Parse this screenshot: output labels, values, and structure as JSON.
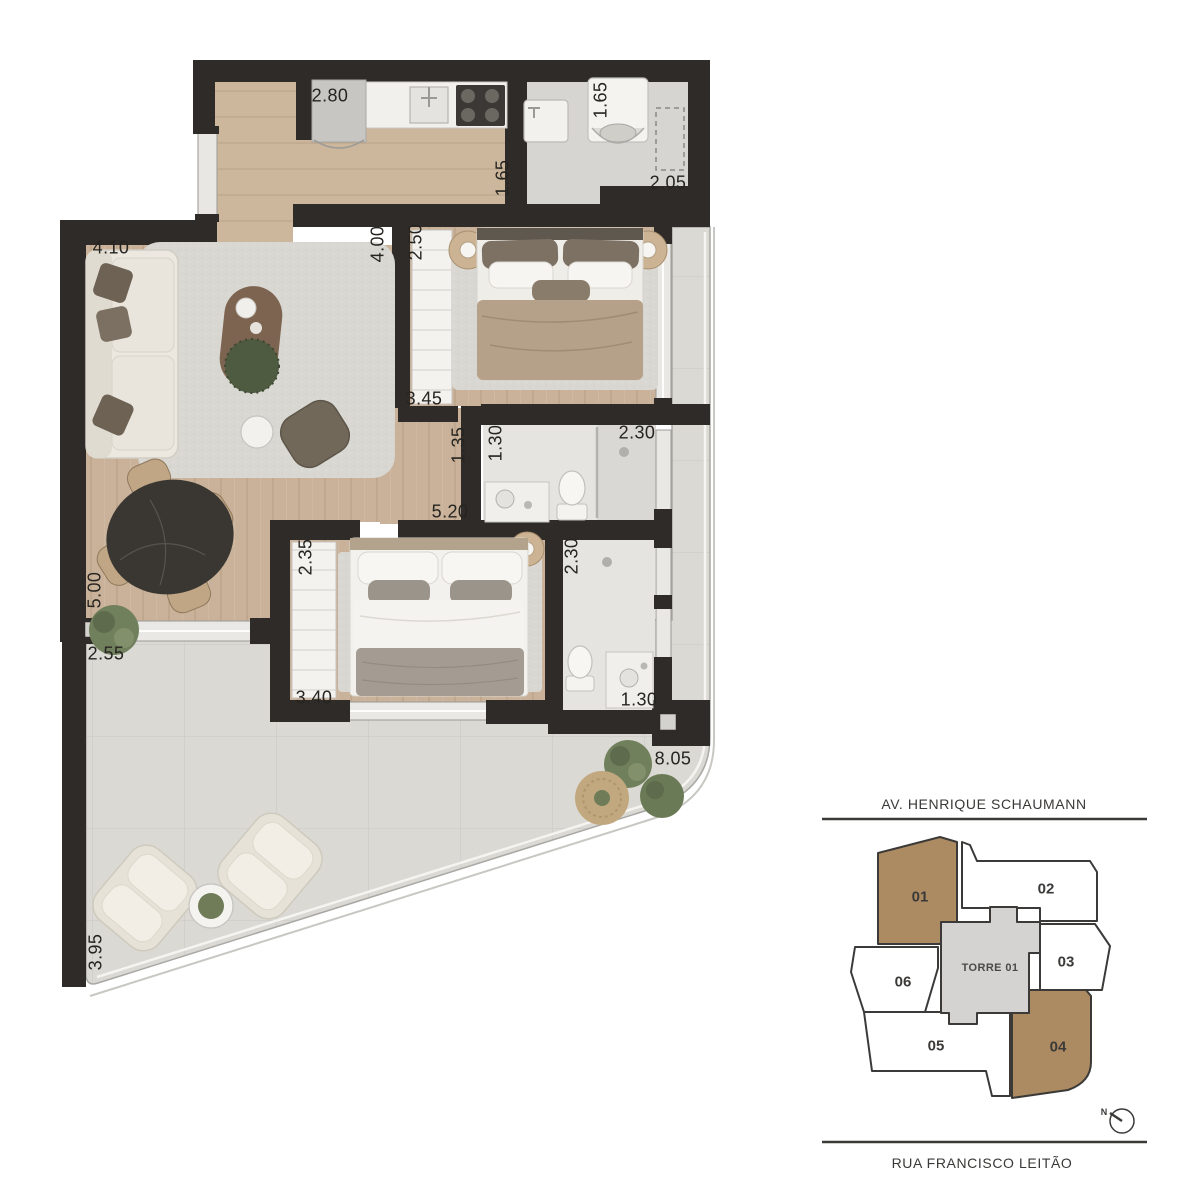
{
  "floor_plan": {
    "dimensions": [
      {
        "room": "kitchen-width",
        "value": "2.80"
      },
      {
        "room": "kitchen-depth",
        "value": "1.65"
      },
      {
        "room": "laundry-depth",
        "value": "1.65"
      },
      {
        "room": "laundry-width",
        "value": "2.05"
      },
      {
        "room": "living-width",
        "value": "4.10"
      },
      {
        "room": "living-depth",
        "value": "4.00"
      },
      {
        "room": "suite-closet",
        "value": "2.50"
      },
      {
        "room": "suite-width",
        "value": "3.45"
      },
      {
        "room": "hallway-width",
        "value": "1.35"
      },
      {
        "room": "bathroom1-width",
        "value": "1.30"
      },
      {
        "room": "bathroom1-shower",
        "value": "2.30"
      },
      {
        "room": "living-length",
        "value": "5.20"
      },
      {
        "room": "bedroom2-closet",
        "value": "2.35"
      },
      {
        "room": "bathroom2-shower",
        "value": "2.30"
      },
      {
        "room": "living-side",
        "value": "5.00"
      },
      {
        "room": "terrace-left",
        "value": "2.55"
      },
      {
        "room": "bedroom2-width",
        "value": "3.40"
      },
      {
        "room": "bathroom2-width",
        "value": "1.30"
      },
      {
        "room": "terrace-width",
        "value": "8.05"
      },
      {
        "room": "terrace-bottom",
        "value": "3.95"
      }
    ]
  },
  "key_plan": {
    "street_top": "AV. HENRIQUE SCHAUMANN",
    "street_bottom": "RUA FRANCISCO LEITÃO",
    "tower_label": "TORRE 01",
    "units": [
      {
        "label": "01",
        "highlighted": true
      },
      {
        "label": "02",
        "highlighted": false
      },
      {
        "label": "03",
        "highlighted": false
      },
      {
        "label": "04",
        "highlighted": true
      },
      {
        "label": "05",
        "highlighted": false
      },
      {
        "label": "06",
        "highlighted": false
      }
    ],
    "compass_label": "N"
  },
  "colors": {
    "wall": "#2e2b28",
    "wood": "#c9b299",
    "terrace": "#dad9d4",
    "tile": "#e5e4e1",
    "keyplan_highlight": "#ac8b62",
    "keyplan_tower": "#d4d3d1",
    "keyplan_outline": "#3b3a38"
  }
}
